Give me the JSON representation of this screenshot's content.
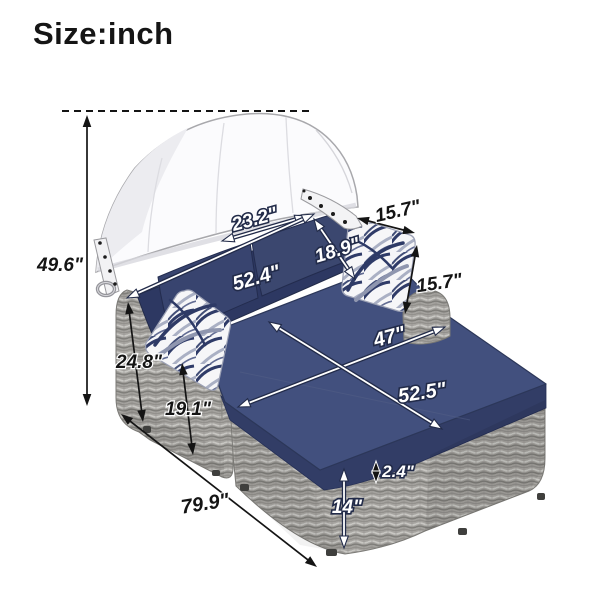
{
  "title": "Size:inch",
  "unit": "inch",
  "product_name": "Outdoor wicker daybed with canopy",
  "colors": {
    "background": "#ffffff",
    "cushion_navy": "#42507e",
    "cushion_navy_dark": "#323d66",
    "backrest_navy": "#2d3862",
    "rattan_gray": "#a6a4a0",
    "canopy_white": "#fbfbfd",
    "annotation_black": "#141414",
    "annotation_white": "#ffffff",
    "annotation_outline": "#222b49"
  },
  "annotations": [
    {
      "id": "canopy-top-dashed-line",
      "type": "dashed",
      "arrow": {
        "x1": 62,
        "y1": 111,
        "x2": 313,
        "y2": 111
      }
    },
    {
      "id": "overall-height",
      "text": "49.6\"",
      "label": {
        "x": 60,
        "y": 271,
        "rot": 0,
        "size": 19,
        "style": "black"
      },
      "arrow": {
        "x1": 87,
        "y1": 115,
        "x2": 87,
        "y2": 406,
        "style": "black"
      }
    },
    {
      "id": "backrest-width",
      "text": "23.2\"",
      "label": {
        "x": 256,
        "y": 225,
        "rot": -15,
        "size": 19,
        "style": "white"
      },
      "arrow": {
        "x1": 222,
        "y1": 241,
        "x2": 307,
        "y2": 216,
        "style": "white"
      }
    },
    {
      "id": "bed-back-width",
      "text": "52.4\"",
      "label": {
        "x": 258,
        "y": 284,
        "rot": -16,
        "size": 20,
        "style": "white"
      },
      "arrow": {
        "x1": 127,
        "y1": 298,
        "x2": 314,
        "y2": 214,
        "style": "white"
      }
    },
    {
      "id": "pillow-diagonal",
      "text": "18.9\"",
      "label": {
        "x": 339,
        "y": 256,
        "rot": -17,
        "size": 19,
        "style": "white"
      },
      "arrow": {
        "x1": 314,
        "y1": 219,
        "x2": 355,
        "y2": 279,
        "style": "white"
      }
    },
    {
      "id": "pillow-width",
      "text": "15.7\"",
      "label": {
        "x": 399,
        "y": 217,
        "rot": -13,
        "size": 19,
        "style": "black"
      },
      "arrow": {
        "x1": 357,
        "y1": 218,
        "x2": 415,
        "y2": 233,
        "style": "black"
      }
    },
    {
      "id": "pillow-height",
      "text": "15.7\"",
      "label": {
        "x": 440,
        "y": 289,
        "rot": -8,
        "size": 19,
        "style": "black"
      },
      "arrow": {
        "x1": 417,
        "y1": 245,
        "x2": 405,
        "y2": 314,
        "style": "black"
      }
    },
    {
      "id": "seat-width",
      "text": "47\"",
      "label": {
        "x": 391,
        "y": 343,
        "rot": -15,
        "size": 20,
        "style": "white"
      },
      "arrow": {
        "x1": 238,
        "y1": 407,
        "x2": 445,
        "y2": 327,
        "style": "white"
      }
    },
    {
      "id": "seat-length",
      "text": "52.5\"",
      "label": {
        "x": 423,
        "y": 399,
        "rot": -9,
        "size": 20,
        "style": "white"
      },
      "arrow": {
        "x1": 269,
        "y1": 322,
        "x2": 442,
        "y2": 429,
        "style": "white"
      }
    },
    {
      "id": "armrest-height",
      "text": "24.8\"",
      "label": {
        "x": 139,
        "y": 368,
        "rot": 0,
        "size": 19,
        "style": "black"
      },
      "arrow": {
        "x1": 128,
        "y1": 302,
        "x2": 143,
        "y2": 422,
        "style": "black"
      }
    },
    {
      "id": "seat-height",
      "text": "19.1\"",
      "label": {
        "x": 188,
        "y": 415,
        "rot": 0,
        "size": 19,
        "style": "black"
      },
      "arrow": {
        "x1": 182,
        "y1": 363,
        "x2": 193,
        "y2": 455,
        "style": "black"
      }
    },
    {
      "id": "bed-length",
      "text": "79.9\"",
      "label": {
        "x": 206,
        "y": 510,
        "rot": -9,
        "size": 20,
        "style": "black"
      },
      "arrow": {
        "x1": 121,
        "y1": 414,
        "x2": 317,
        "y2": 567,
        "style": "black"
      }
    },
    {
      "id": "cushion-thickness",
      "text": "2.4\"",
      "label": {
        "x": 398,
        "y": 477,
        "rot": 0,
        "size": 17,
        "style": "white"
      },
      "arrow": {
        "x1": 376,
        "y1": 461,
        "x2": 376,
        "y2": 483,
        "style": "cased",
        "small": true
      }
    },
    {
      "id": "base-height",
      "text": "14\"",
      "label": {
        "x": 347,
        "y": 513,
        "rot": 0,
        "size": 19,
        "style": "white"
      },
      "arrow": {
        "x1": 344,
        "y1": 469,
        "x2": 344,
        "y2": 548,
        "style": "white"
      }
    }
  ]
}
